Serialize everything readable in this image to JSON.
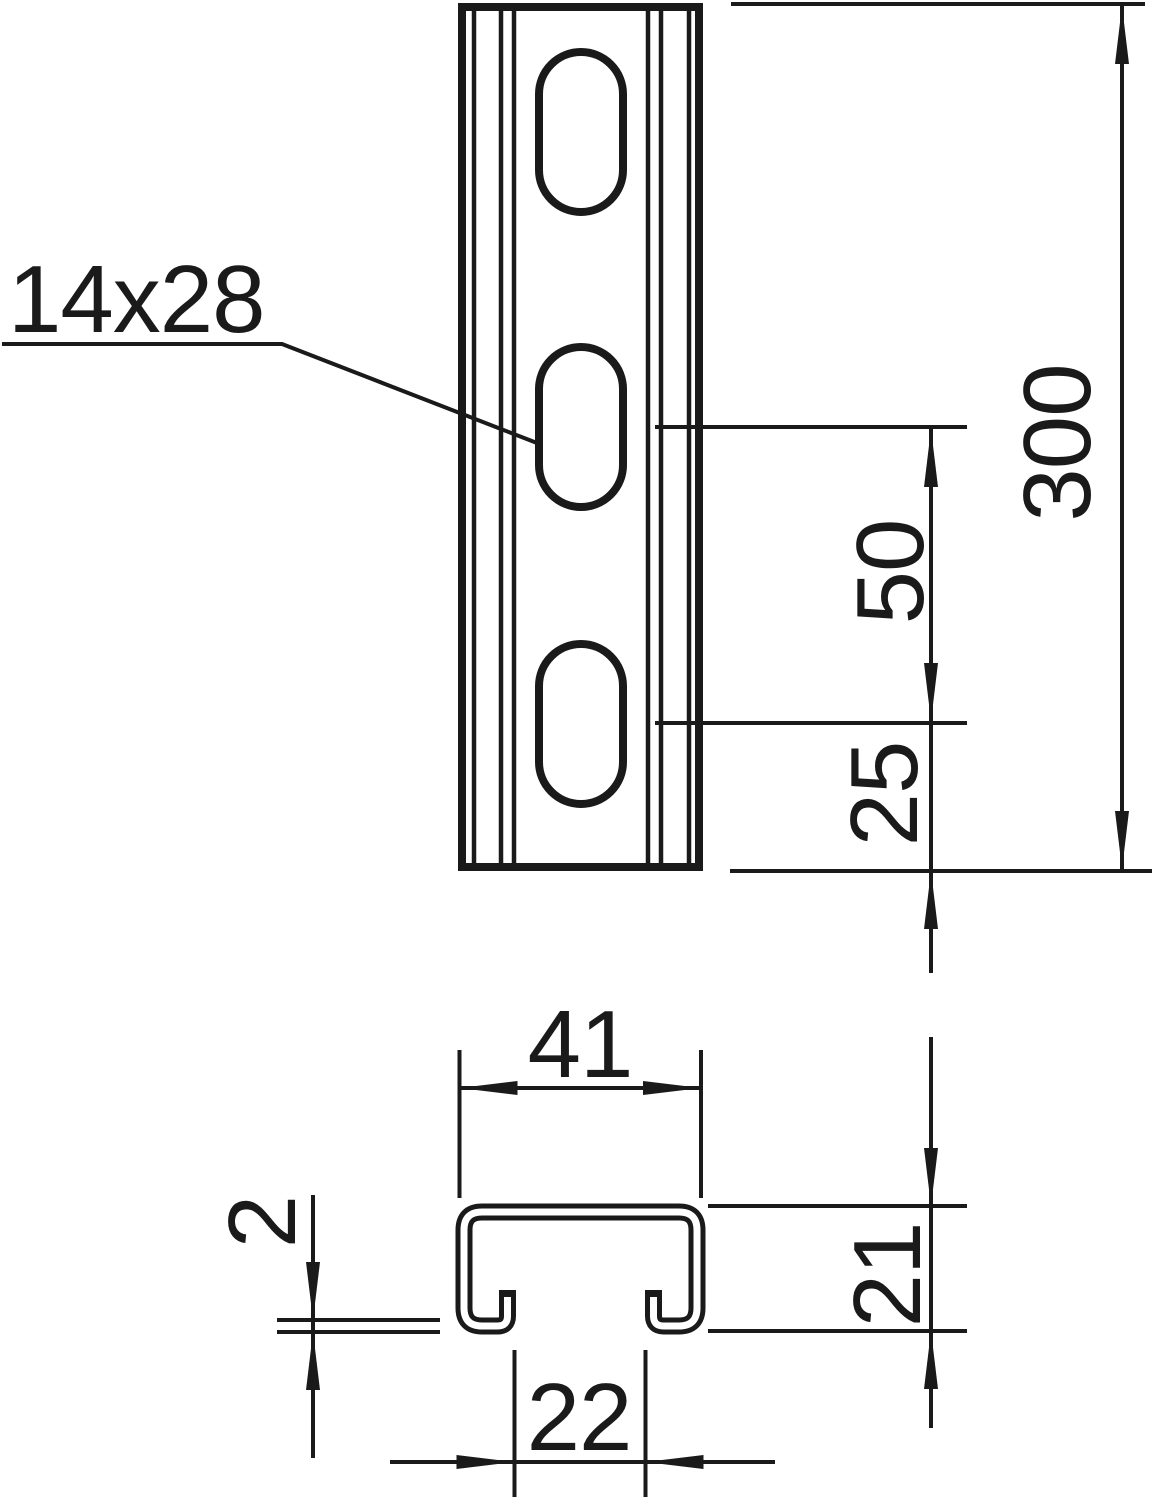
{
  "drawing": {
    "type": "technical-drawing",
    "description": "Slotted strut mounting rail: front view with oblong holes and C-profile cross-section with dimensions (mm)",
    "front_view": {
      "slot_size_label": "14x28",
      "slot_count": 3,
      "dimensions": {
        "total_length": "300",
        "slot_pitch": "50",
        "slot_end_offset": "25"
      }
    },
    "cross_section": {
      "dimensions": {
        "outer_width": "41",
        "outer_height": "21",
        "material_thickness": "2",
        "slot_opening": "22"
      }
    },
    "colors": {
      "line": "#1a1a1a",
      "background": "#ffffff"
    }
  }
}
